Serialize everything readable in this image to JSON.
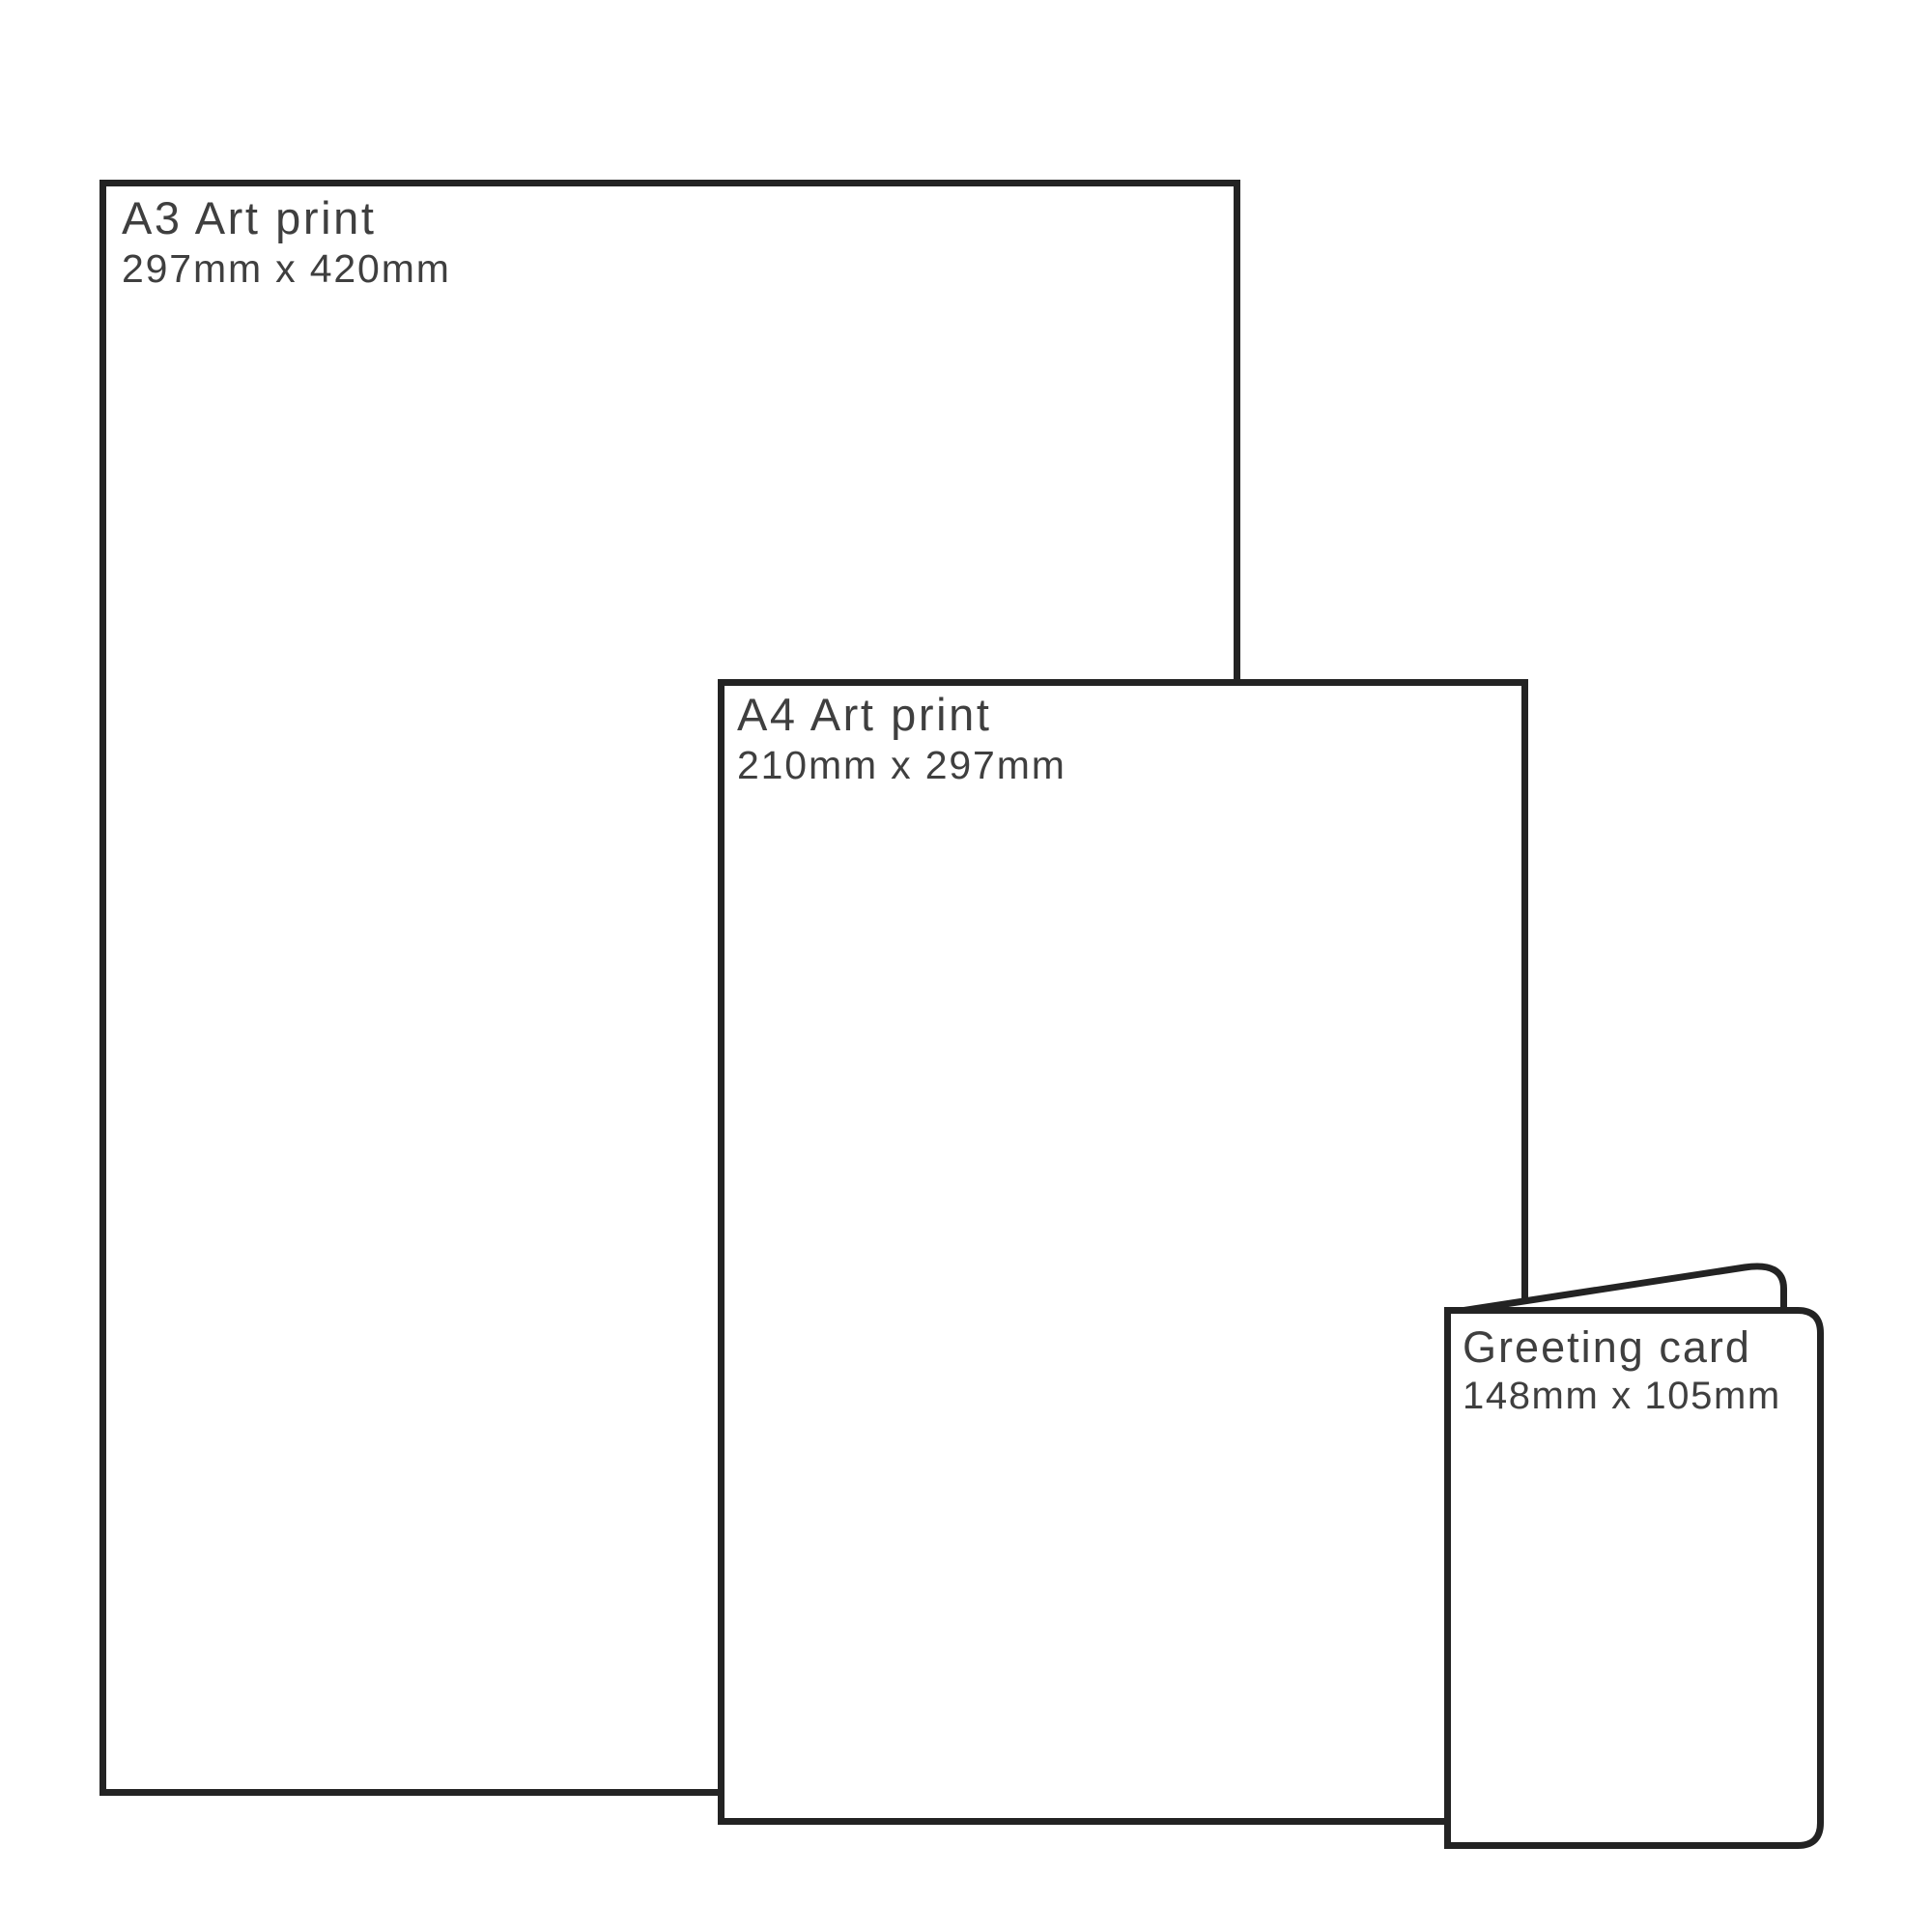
{
  "diagram": {
    "description": "Print product size comparison",
    "background_color": "#ffffff",
    "outline_color": "#232323",
    "text_color": "#3f3f3f",
    "products": [
      {
        "name": "A3 Art print",
        "dimensions": "297mm x 420mm"
      },
      {
        "name": "A4 Art print",
        "dimensions": "210mm x 297mm"
      },
      {
        "name": "Greeting card",
        "dimensions": "148mm x 105mm"
      }
    ]
  }
}
